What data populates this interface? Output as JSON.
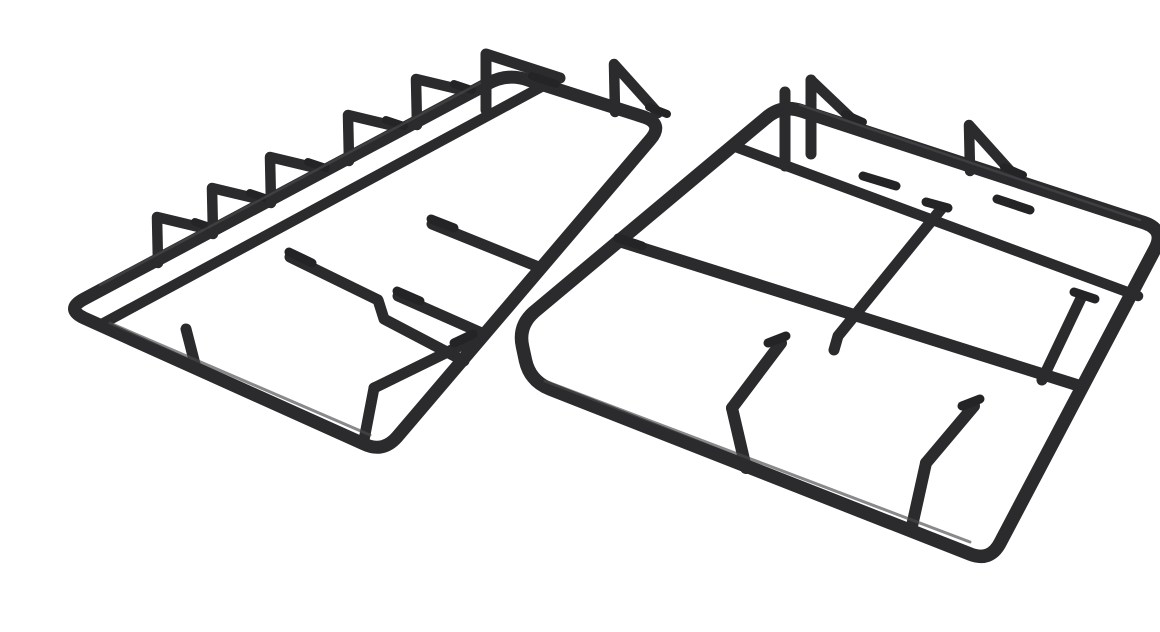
{
  "page": {
    "background": "#ffffff"
  },
  "product": {
    "name": "Cast iron pan support grids",
    "description": "Two matte black cast-iron pan support grates for a gas hob, photographed at an angle on a plain white background. Each grate has a rounded rectangular outer rim, parallel inner rails, upward triangular finger prongs along the back edges, corner risers and stepped pan-support fingers pointing toward the burner openings.",
    "item_count": 2,
    "colors": {
      "iron": "#2b2b2d",
      "iron_dark": "#242426",
      "iron_highlight": "#4a4a4d",
      "background": "#ffffff"
    },
    "parts": {
      "left_grid": {
        "label": "left pan support",
        "prong_count": 5,
        "corner_risers": 1,
        "fingers": 4
      },
      "right_grid": {
        "label": "right pan support",
        "prong_count": 2,
        "corner_risers": 2,
        "fingers": 5
      }
    }
  }
}
